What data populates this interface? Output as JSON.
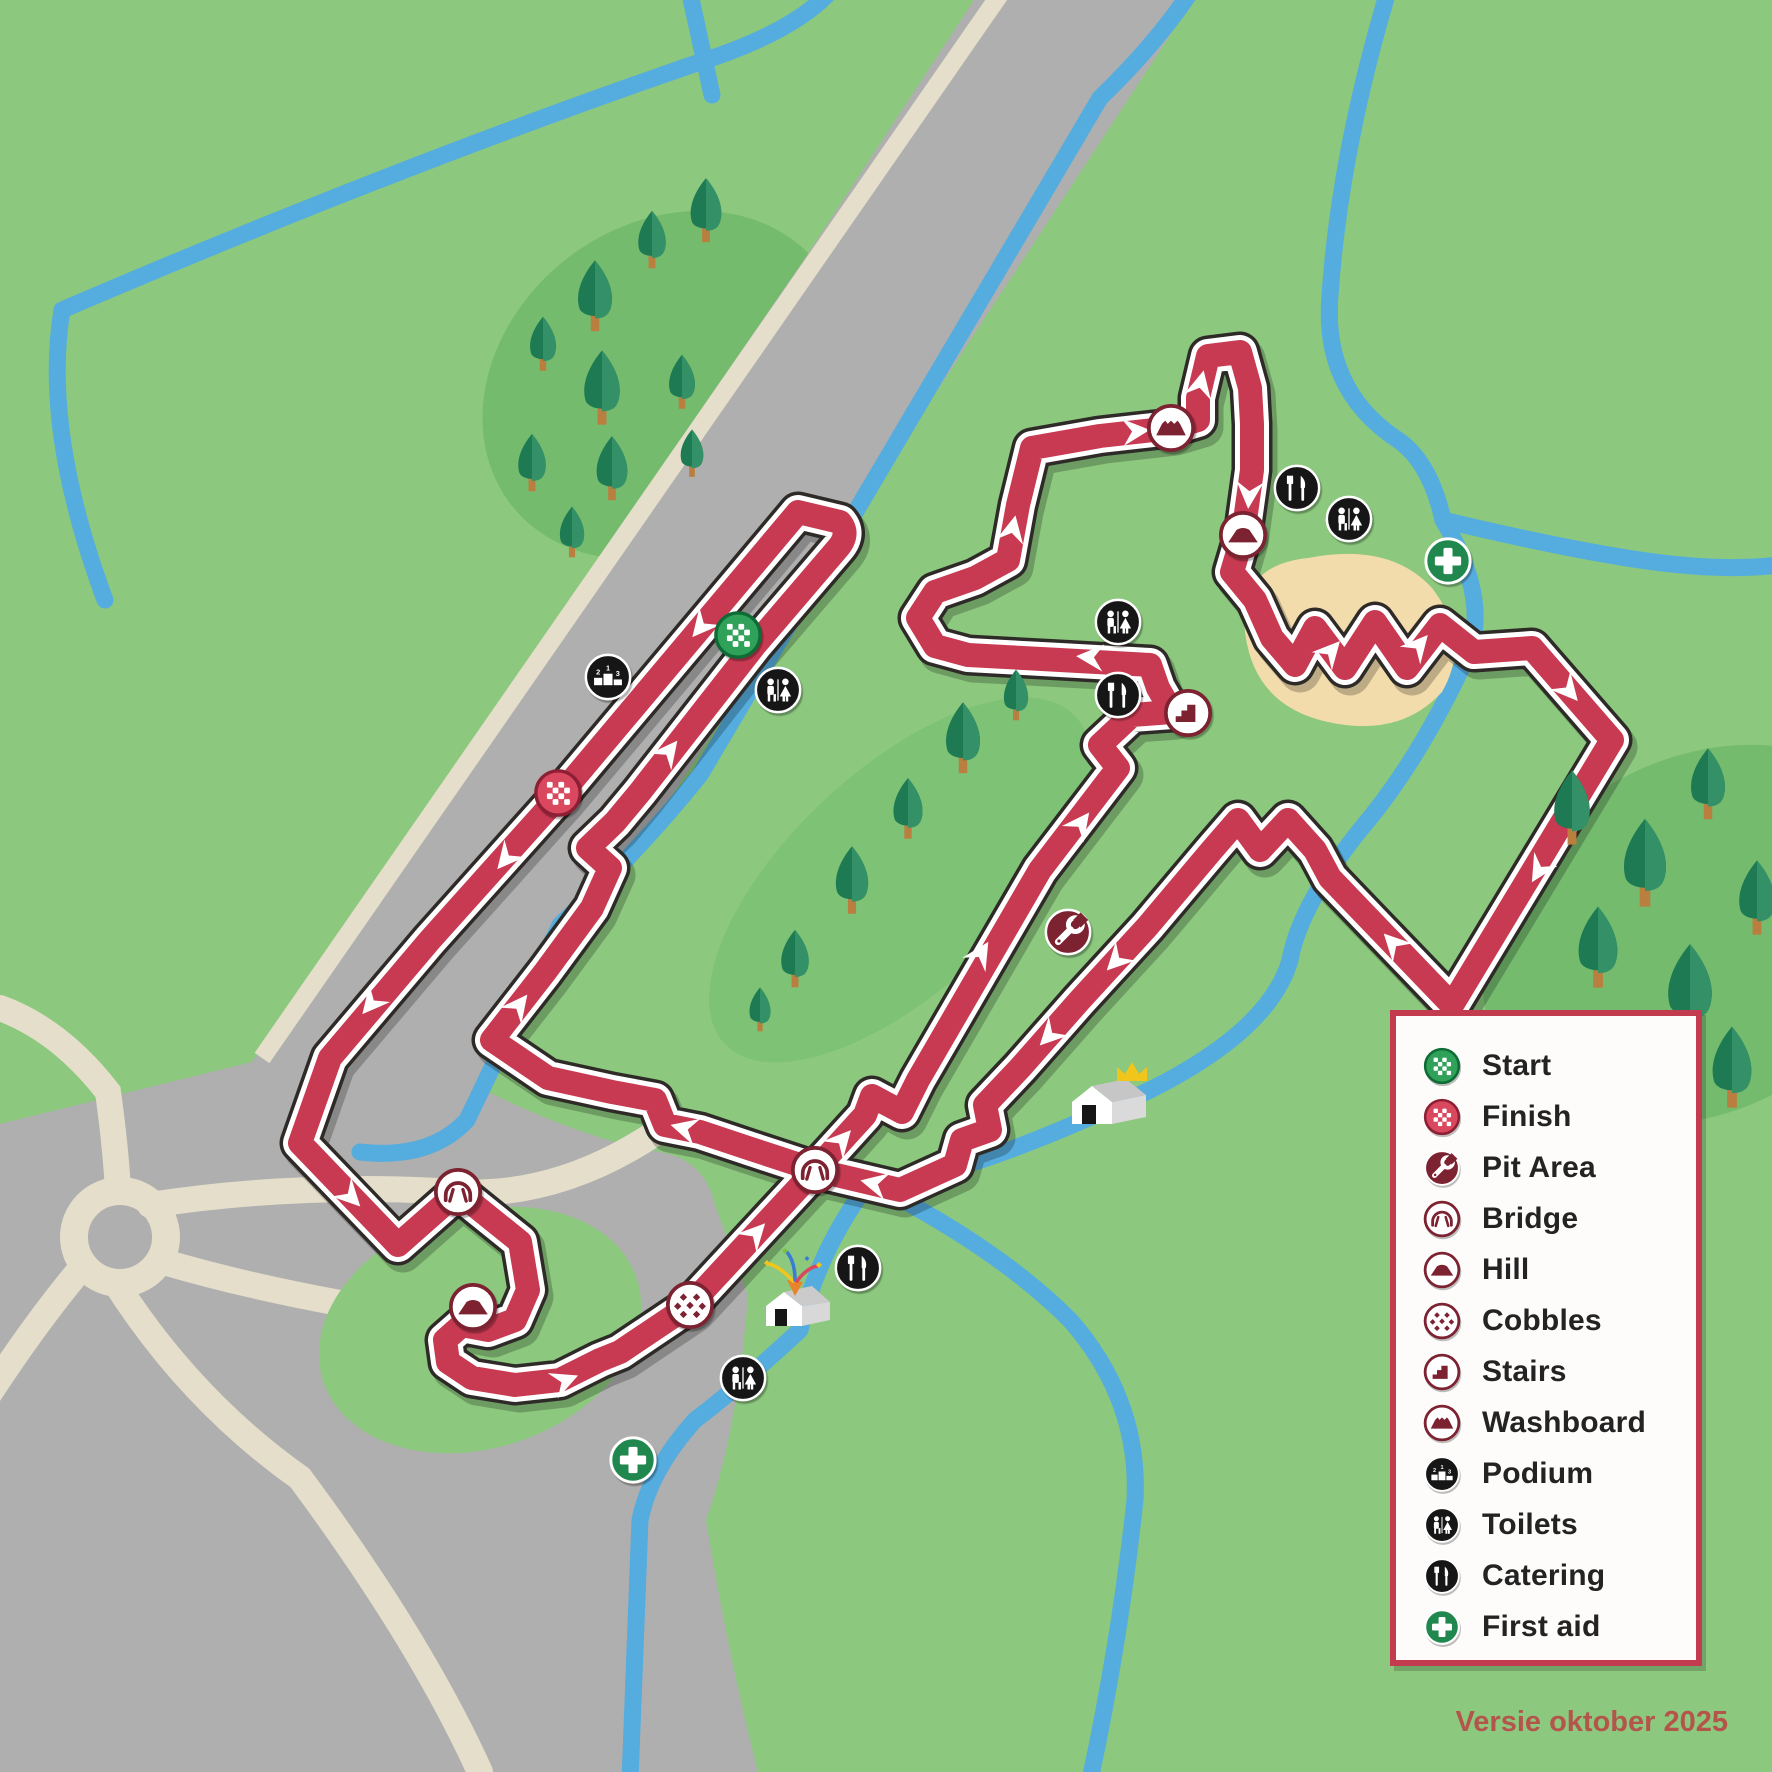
{
  "version_text": "Versie oktober 2025",
  "colors": {
    "background": "#8CC87E",
    "forest_blob": "#74BB6E",
    "forest_blob_light": "#7EC276",
    "road_gray": "#AFAFAF",
    "path_beige": "#E5DECB",
    "stream_blue": "#55ACDE",
    "course_red": "#C83A52",
    "course_outline": "#2E2A27",
    "icon_maroon": "#7C2231",
    "start_green": "#2FA158",
    "finish_red": "#D9485E",
    "icon_black": "#161616",
    "firstaid_green": "#20874E",
    "sand": "#F3DCAB",
    "legend_border": "#C23B4E",
    "legend_text": "#232323",
    "version_color": "#B4554C"
  },
  "legend": {
    "items": [
      {
        "id": "start",
        "label": "Start"
      },
      {
        "id": "finish",
        "label": "Finish"
      },
      {
        "id": "pit",
        "label": "Pit Area"
      },
      {
        "id": "bridge",
        "label": "Bridge"
      },
      {
        "id": "hill",
        "label": "Hill"
      },
      {
        "id": "cobbles",
        "label": "Cobbles"
      },
      {
        "id": "stairs",
        "label": "Stairs"
      },
      {
        "id": "washboard",
        "label": "Washboard"
      },
      {
        "id": "podium",
        "label": "Podium"
      },
      {
        "id": "toilets",
        "label": "Toilets"
      },
      {
        "id": "catering",
        "label": "Catering"
      },
      {
        "id": "firstaid",
        "label": "First aid"
      }
    ]
  },
  "map": {
    "icons": [
      {
        "type": "podium",
        "x": 608,
        "y": 677
      },
      {
        "type": "start",
        "x": 738,
        "y": 635
      },
      {
        "type": "toilets",
        "x": 778,
        "y": 690
      },
      {
        "type": "finish",
        "x": 558,
        "y": 793
      },
      {
        "type": "washboard",
        "x": 1171,
        "y": 428
      },
      {
        "type": "hill",
        "x": 1243,
        "y": 535
      },
      {
        "type": "catering",
        "x": 1297,
        "y": 488
      },
      {
        "type": "toilets",
        "x": 1349,
        "y": 519
      },
      {
        "type": "firstaid",
        "x": 1448,
        "y": 561
      },
      {
        "type": "toilets",
        "x": 1118,
        "y": 622
      },
      {
        "type": "catering",
        "x": 1118,
        "y": 695
      },
      {
        "type": "stairs",
        "x": 1188,
        "y": 713
      },
      {
        "type": "pit",
        "x": 1068,
        "y": 932
      },
      {
        "type": "bridge",
        "x": 815,
        "y": 1170
      },
      {
        "type": "bridge",
        "x": 458,
        "y": 1192
      },
      {
        "type": "hill",
        "x": 473,
        "y": 1307
      },
      {
        "type": "cobbles",
        "x": 690,
        "y": 1305
      },
      {
        "type": "catering",
        "x": 858,
        "y": 1268
      },
      {
        "type": "toilets",
        "x": 743,
        "y": 1378
      },
      {
        "type": "firstaid",
        "x": 633,
        "y": 1460
      }
    ],
    "arrows": [
      [
        700,
        628,
        130
      ],
      [
        505,
        860,
        130
      ],
      [
        370,
        1005,
        130
      ],
      [
        352,
        1198,
        46
      ],
      [
        567,
        1380,
        -22
      ],
      [
        757,
        1232,
        -47
      ],
      [
        843,
        1139,
        -48
      ],
      [
        982,
        952,
        -58
      ],
      [
        1082,
        822,
        -53
      ],
      [
        1088,
        657,
        184
      ],
      [
        1013,
        527,
        -78
      ],
      [
        1138,
        431,
        -5
      ],
      [
        1201,
        382,
        -77
      ],
      [
        1249,
        497,
        94
      ],
      [
        1332,
        650,
        -48
      ],
      [
        1420,
        644,
        -49
      ],
      [
        1570,
        692,
        49
      ],
      [
        1538,
        872,
        121
      ],
      [
        1392,
        942,
        226
      ],
      [
        1115,
        962,
        134
      ],
      [
        1048,
        1037,
        134
      ],
      [
        872,
        1183,
        193
      ],
      [
        682,
        1128,
        195
      ],
      [
        520,
        1004,
        -52
      ],
      [
        670,
        750,
        -52
      ]
    ],
    "trees": [
      [
        595,
        300,
        1.05
      ],
      [
        652,
        243,
        0.85
      ],
      [
        706,
        214,
        0.95
      ],
      [
        543,
        347,
        0.8
      ],
      [
        602,
        392,
        1.1
      ],
      [
        682,
        385,
        0.8
      ],
      [
        532,
        466,
        0.85
      ],
      [
        612,
        472,
        0.95
      ],
      [
        692,
        456,
        0.7
      ],
      [
        572,
        535,
        0.75
      ],
      [
        795,
        962,
        0.85
      ],
      [
        852,
        884,
        1.0
      ],
      [
        908,
        812,
        0.9
      ],
      [
        963,
        742,
        1.05
      ],
      [
        1016,
        698,
        0.75
      ],
      [
        760,
        1012,
        0.65
      ],
      [
        1572,
        812,
        1.1
      ],
      [
        1645,
        868,
        1.3
      ],
      [
        1708,
        788,
        1.05
      ],
      [
        1598,
        952,
        1.2
      ],
      [
        1690,
        995,
        1.35
      ],
      [
        1757,
        902,
        1.1
      ],
      [
        1630,
        1062,
        1.0
      ],
      [
        1732,
        1072,
        1.2
      ]
    ],
    "buildings": [
      {
        "type": "house-crown",
        "x": 1112,
        "y": 1118
      },
      {
        "type": "house-confetti",
        "x": 800,
        "y": 1318
      }
    ]
  }
}
